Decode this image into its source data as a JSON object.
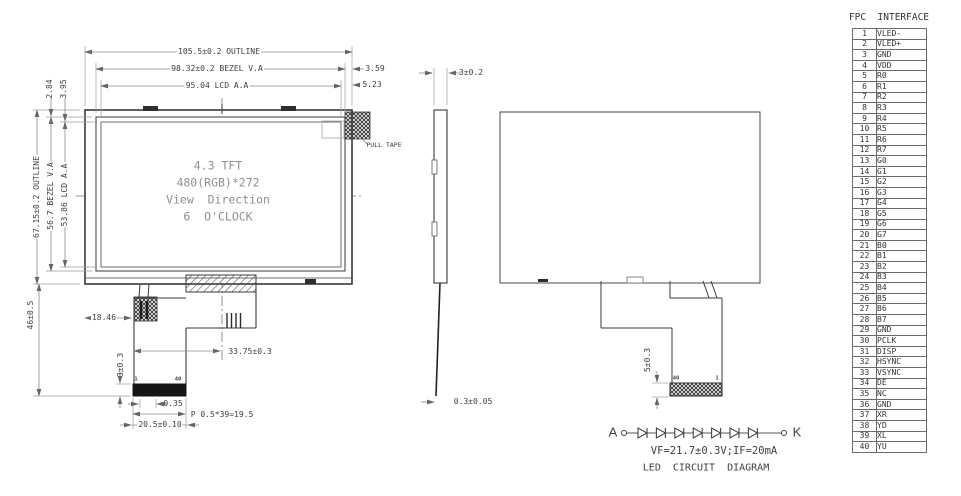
{
  "front_view": {
    "dims": {
      "outline_w": "105.5±0.2 OUTLINE",
      "bezel_w": "98.32±0.2 BEZEL V.A",
      "lcd_w": "95.04 LCD A.A",
      "off_r1": "3.59",
      "off_r2": "5.23",
      "off_l1": "2.84",
      "off_l2": "3.95",
      "outline_h": "67.15±0.2 OUTLINE",
      "bezel_h": "56.7 BEZEL V.A",
      "lcd_h": "53.86 LCD A.A",
      "fpc_drop": "46±0.5",
      "fpc_offset": "18.46",
      "fpc_center": "33.75±0.3",
      "conn_thickness": "3±0.3",
      "pin_margin": "0.35",
      "pin_pitch": "P 0.5*39=19.5",
      "conn_width": "20.5±0.10",
      "pull_tape": "PULL TAPE",
      "conn_pin1": "1",
      "conn_pin40": "40"
    },
    "screen_text": [
      "4.3 TFT",
      "480(RGB)*272",
      "View  Direction",
      "6  O'CLOCK"
    ]
  },
  "side_view": {
    "thickness": "3±0.2",
    "fpc_thickness": "0.3±0.05"
  },
  "rear_view": {
    "fpc_tail": "5±0.3",
    "pin40": "40",
    "pin1": "1"
  },
  "led_circuit": {
    "anode": "A",
    "cathode": "K",
    "spec": "VF=21.7±0.3V;IF=20mA",
    "title": "LED  CIRCUIT  DIAGRAM",
    "diode_count": 7
  },
  "fpc_interface": {
    "title": "FPC  INTERFACE",
    "pins": [
      {
        "no": 1,
        "name": "VLED-"
      },
      {
        "no": 2,
        "name": "VLED+"
      },
      {
        "no": 3,
        "name": "GND"
      },
      {
        "no": 4,
        "name": "VDD"
      },
      {
        "no": 5,
        "name": "R0"
      },
      {
        "no": 6,
        "name": "R1"
      },
      {
        "no": 7,
        "name": "R2"
      },
      {
        "no": 8,
        "name": "R3"
      },
      {
        "no": 9,
        "name": "R4"
      },
      {
        "no": 10,
        "name": "R5"
      },
      {
        "no": 11,
        "name": "R6"
      },
      {
        "no": 12,
        "name": "R7"
      },
      {
        "no": 13,
        "name": "G0"
      },
      {
        "no": 14,
        "name": "G1"
      },
      {
        "no": 15,
        "name": "G2"
      },
      {
        "no": 16,
        "name": "G3"
      },
      {
        "no": 17,
        "name": "G4"
      },
      {
        "no": 18,
        "name": "G5"
      },
      {
        "no": 19,
        "name": "G6"
      },
      {
        "no": 20,
        "name": "G7"
      },
      {
        "no": 21,
        "name": "B0"
      },
      {
        "no": 22,
        "name": "B1"
      },
      {
        "no": 23,
        "name": "B2"
      },
      {
        "no": 24,
        "name": "B3"
      },
      {
        "no": 25,
        "name": "B4"
      },
      {
        "no": 26,
        "name": "B5"
      },
      {
        "no": 27,
        "name": "B6"
      },
      {
        "no": 28,
        "name": "B7"
      },
      {
        "no": 29,
        "name": "GND"
      },
      {
        "no": 30,
        "name": "PCLK"
      },
      {
        "no": 31,
        "name": "DISP"
      },
      {
        "no": 32,
        "name": "HSYNC"
      },
      {
        "no": 33,
        "name": "VSYNC"
      },
      {
        "no": 34,
        "name": "DE"
      },
      {
        "no": 35,
        "name": "NC"
      },
      {
        "no": 36,
        "name": "GND"
      },
      {
        "no": 37,
        "name": "XR"
      },
      {
        "no": 38,
        "name": "YD"
      },
      {
        "no": 39,
        "name": "XL"
      },
      {
        "no": 40,
        "name": "YU"
      }
    ]
  }
}
